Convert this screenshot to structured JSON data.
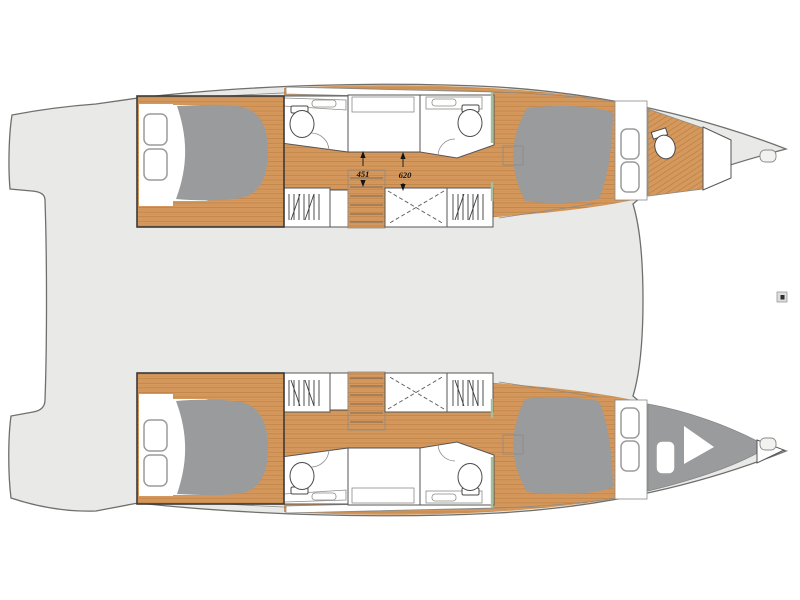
{
  "page": {
    "background": "#ffffff"
  },
  "plan": {
    "annotations": {
      "dim_aft": {
        "label": "451"
      },
      "dim_fwd": {
        "label": "620"
      }
    },
    "colors": {
      "deck": "#e9e9e7",
      "deckLine": "#6f6f6c",
      "wood": "#d6995d",
      "woodDark": "#bb7f42",
      "bed": "#9a9b9d",
      "outline": "#3a3a3a",
      "boxLine": "#565656",
      "thinLine": "#8b8b88",
      "window": "#9c9c9c",
      "accent": "#a5bf9e",
      "dimText": "#141414",
      "hatch": "#f2f2f0",
      "white": "#ffffff"
    },
    "symbols": {
      "toilet-icon": "oval bowl with cistern",
      "sink-icon": "counter with basin",
      "hanging-locker-icon": "vertical zigzag lines",
      "stairs-icon": "wood box with tread lines",
      "storage-locker-icon": "box with dashed X",
      "window-icon": "rounded rectangle",
      "deck-hatch-icon": "small rounded rectangle",
      "berth-icon": "grey rounded mattress",
      "small-marker-icon": "tiny framed square"
    }
  }
}
